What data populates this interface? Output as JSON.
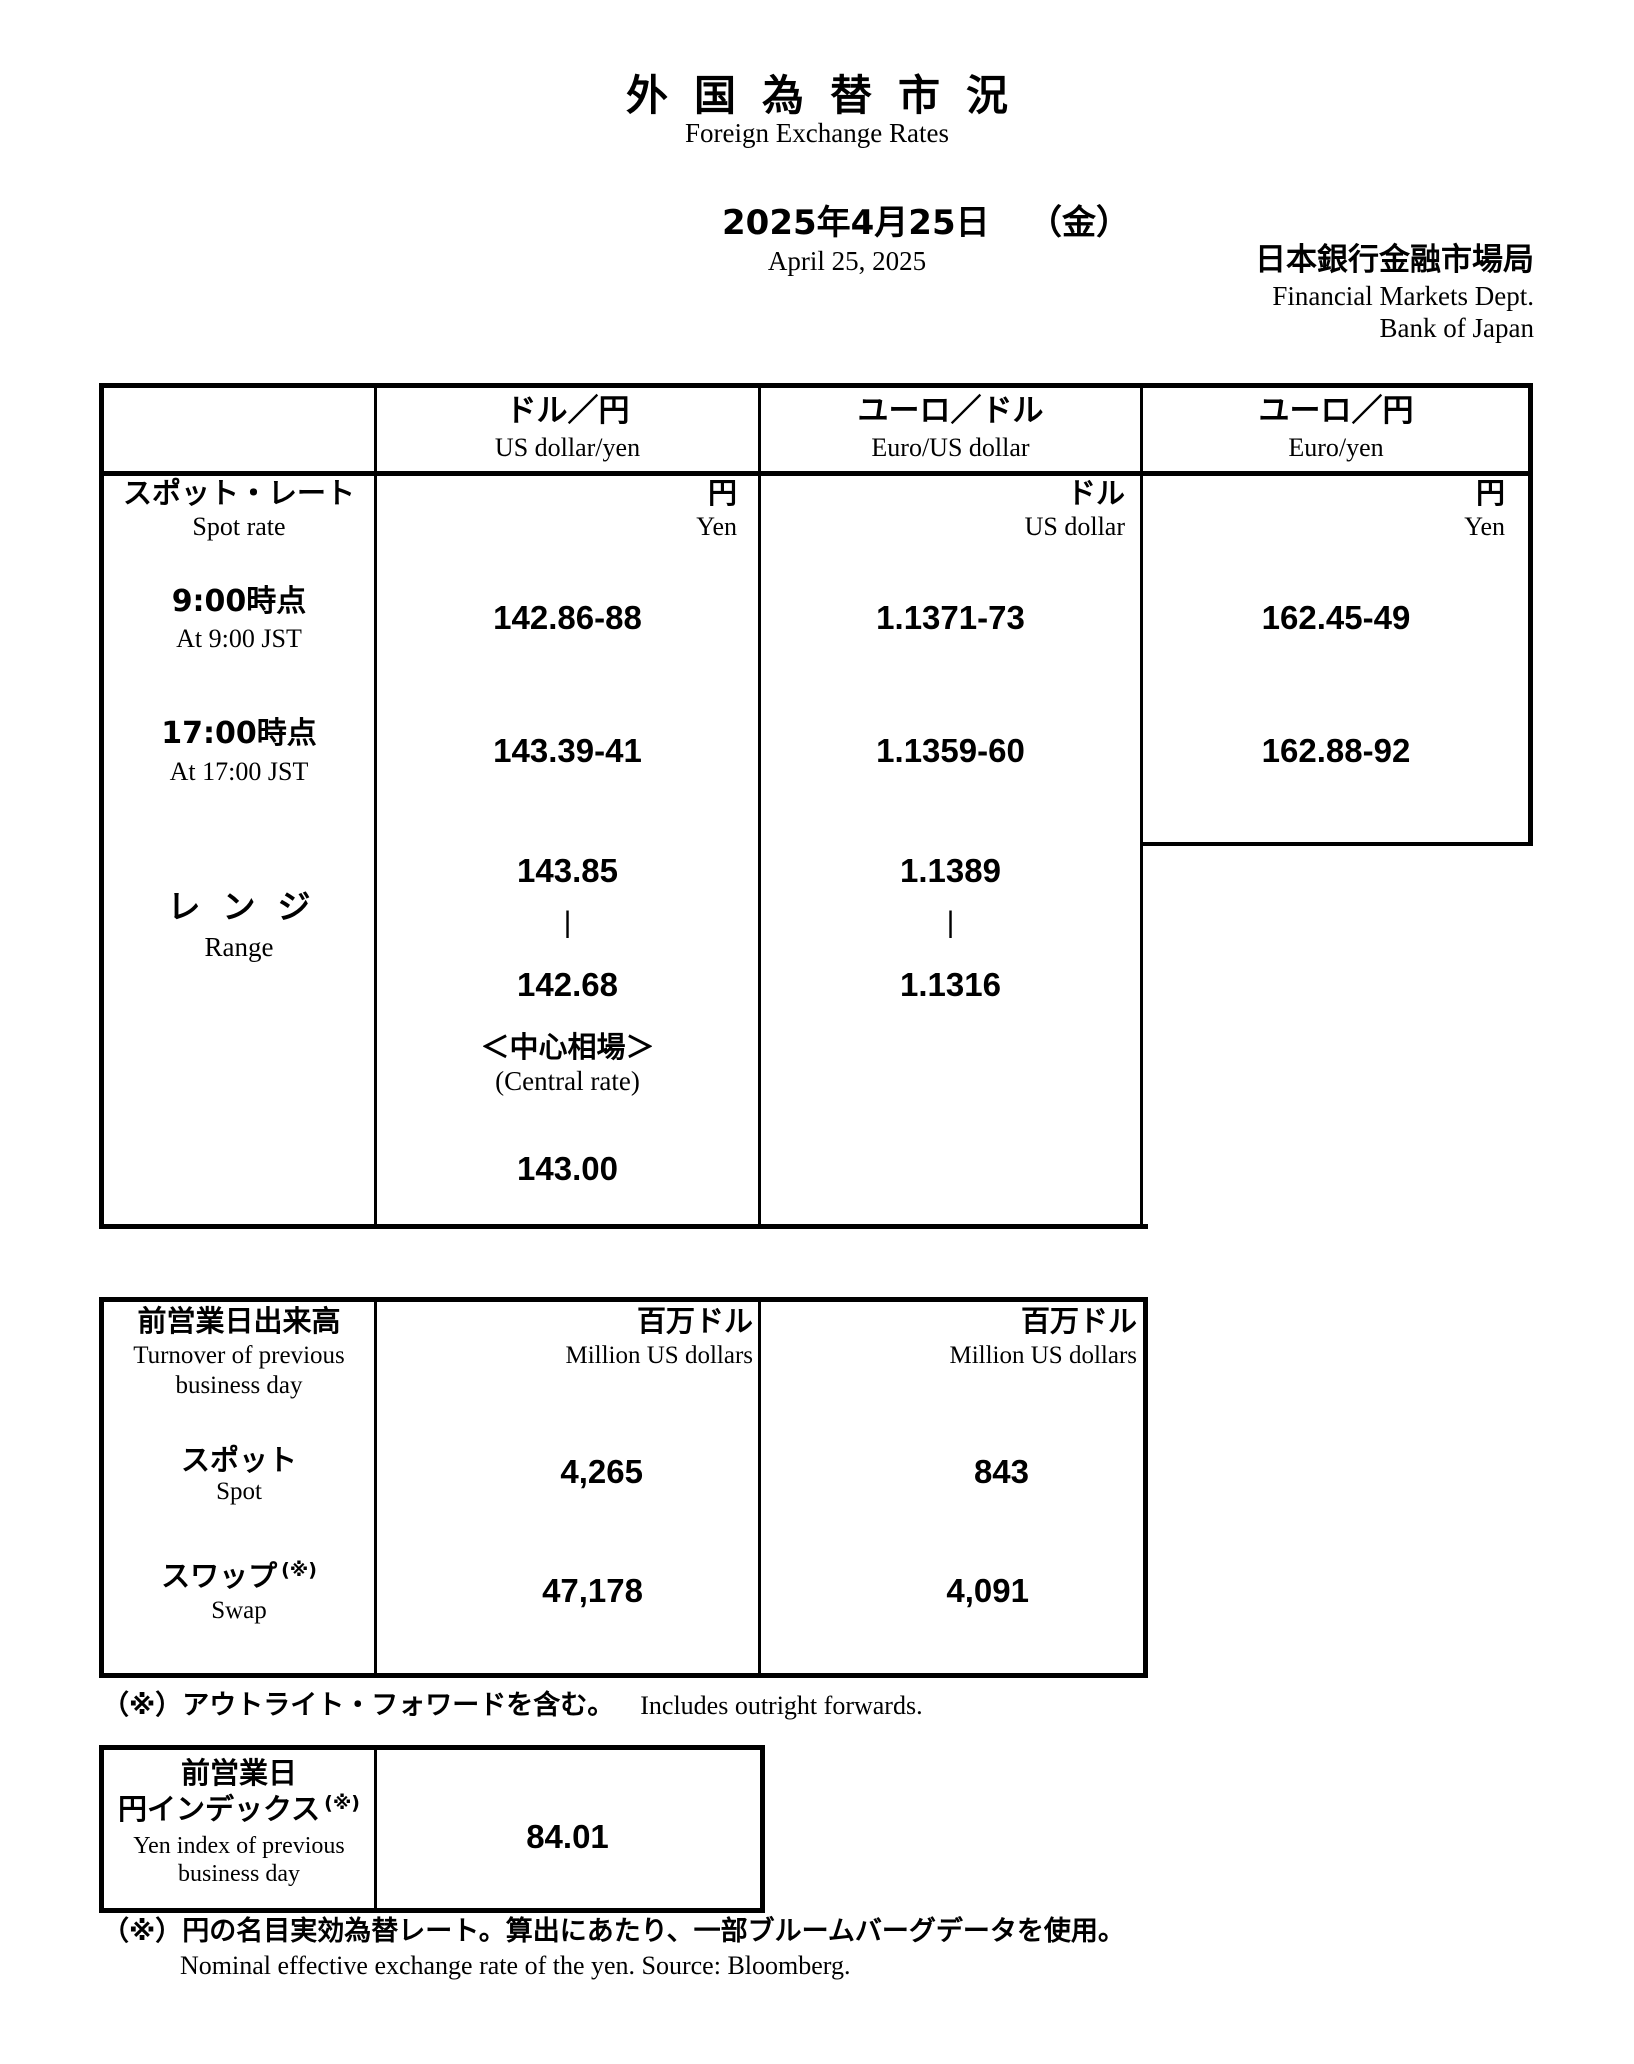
{
  "header": {
    "title_jp": "外国為替市況",
    "title_en": "Foreign Exchange Rates",
    "date_jp": "2025年4月25日",
    "weekday_jp": "（金）",
    "date_en": "April 25, 2025",
    "org_jp": "日本銀行金融市場局",
    "org_en_line1": "Financial Markets Dept.",
    "org_en_line2": "Bank of Japan"
  },
  "rates": {
    "columns": [
      {
        "jp": "ドル／円",
        "en": "US dollar/yen"
      },
      {
        "jp": "ユーロ／ドル",
        "en": "Euro/US dollar"
      },
      {
        "jp": "ユーロ／円",
        "en": "Euro/yen"
      }
    ],
    "spot": {
      "jp": "スポット・レート",
      "en": "Spot rate"
    },
    "units": [
      {
        "jp": "円",
        "en": "Yen"
      },
      {
        "jp": "ドル",
        "en": "US dollar"
      },
      {
        "jp": "円",
        "en": "Yen"
      }
    ],
    "rows": [
      {
        "label_jp": "9:00時点",
        "label_en": "At 9:00 JST",
        "values": [
          "142.86-88",
          "1.1371-73",
          "162.45-49"
        ]
      },
      {
        "label_jp": "17:00時点",
        "label_en": "At 17:00 JST",
        "values": [
          "143.39-41",
          "1.1359-60",
          "162.88-92"
        ]
      }
    ],
    "range": {
      "label_jp": "レンジ",
      "label_en": "Range",
      "cols": [
        {
          "high": "143.85",
          "sep": "|",
          "low": "142.68"
        },
        {
          "high": "1.1389",
          "sep": "|",
          "low": "1.1316"
        }
      ]
    },
    "central": {
      "jp": "＜中心相場＞",
      "en": "(Central rate)",
      "value": "143.00"
    }
  },
  "turnover": {
    "label_jp": "前営業日出来高",
    "label_en_line1": "Turnover of previous",
    "label_en_line2": "business day",
    "unit_jp": "百万ドル",
    "unit_en": "Million US dollars",
    "rows": [
      {
        "label_jp": "スポット",
        "label_en": "Spot",
        "sup": "",
        "values": [
          "4,265",
          "843"
        ]
      },
      {
        "label_jp": "スワップ",
        "label_en": "Swap",
        "sup": "(※)",
        "values": [
          "47,178",
          "4,091"
        ]
      }
    ],
    "footnote_jp": "（※）アウトライト・フォワードを含む。",
    "footnote_en": "Includes outright forwards."
  },
  "yen_index": {
    "label_jp_line1": "前営業日",
    "label_jp_line2": "円インデックス",
    "sup": "(※)",
    "label_en_line1": "Yen index of previous",
    "label_en_line2": "business day",
    "value": "84.01",
    "footnote_jp": "（※）円の名目実効為替レート。算出にあたり、一部ブルームバーグデータを使用。",
    "footnote_en": "Nominal effective exchange rate of the yen. Source: Bloomberg."
  }
}
